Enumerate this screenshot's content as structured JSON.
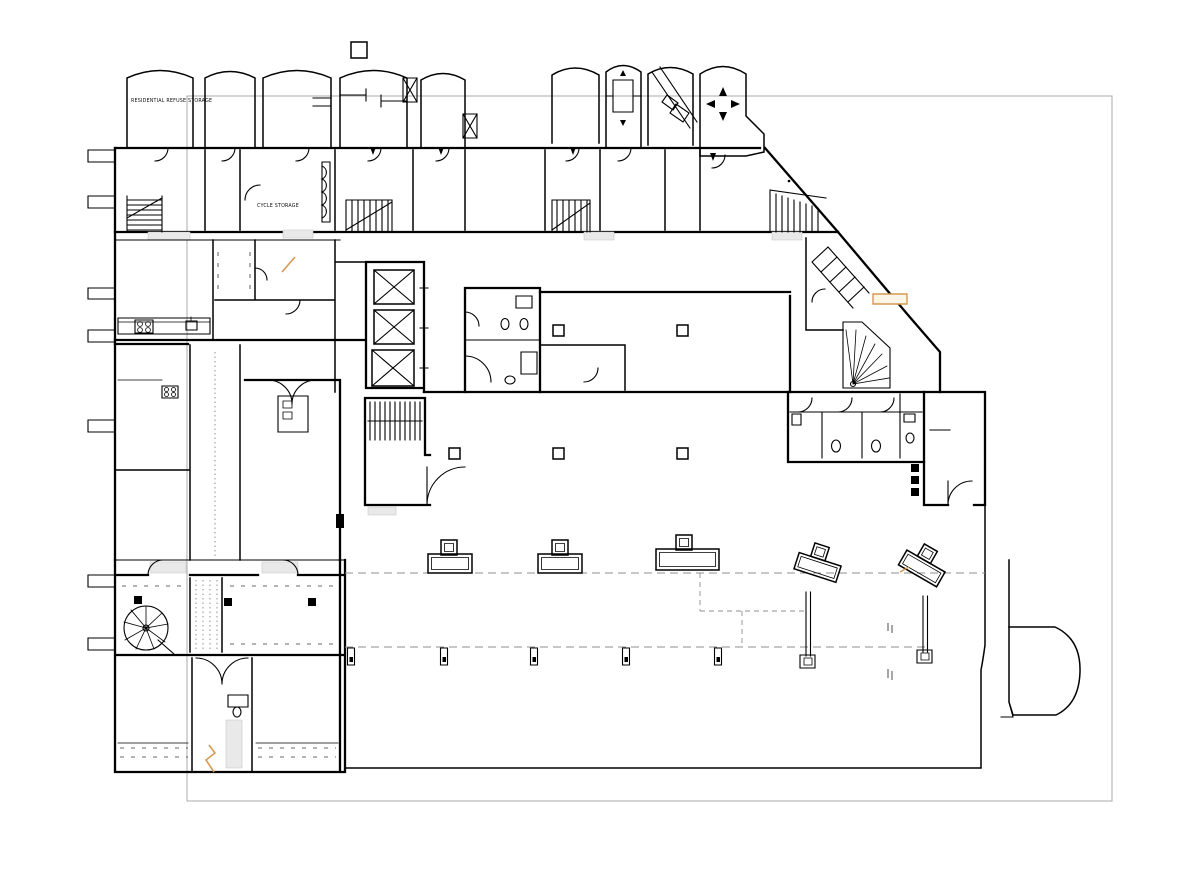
{
  "drawing_type": "architectural-floor-plan",
  "labels": {
    "refuse_storage": "RESIDENTIAL REFUSE STORAGE",
    "cycle_storage": "CYCLE STORAGE"
  },
  "colors": {
    "wall_line": "#000000",
    "page_border": "#ababab",
    "accent": "#d49a52",
    "accent_fill": "#fbf5e8",
    "dashed_guide": "#8f8f8f",
    "threshold_fill": "#e9e9e9",
    "faint_mark": "#a6a6a6"
  },
  "symbols": [
    "elevator-x-icon",
    "stair-icon",
    "spiral-stair-icon",
    "winder-stair-icon",
    "toilet-icon",
    "cooktop-icon",
    "column-marker-icon",
    "direction-arrows-icon",
    "door-swing-icon",
    "bike-rack-icon",
    "break-line-icon",
    "footing-icon"
  ]
}
